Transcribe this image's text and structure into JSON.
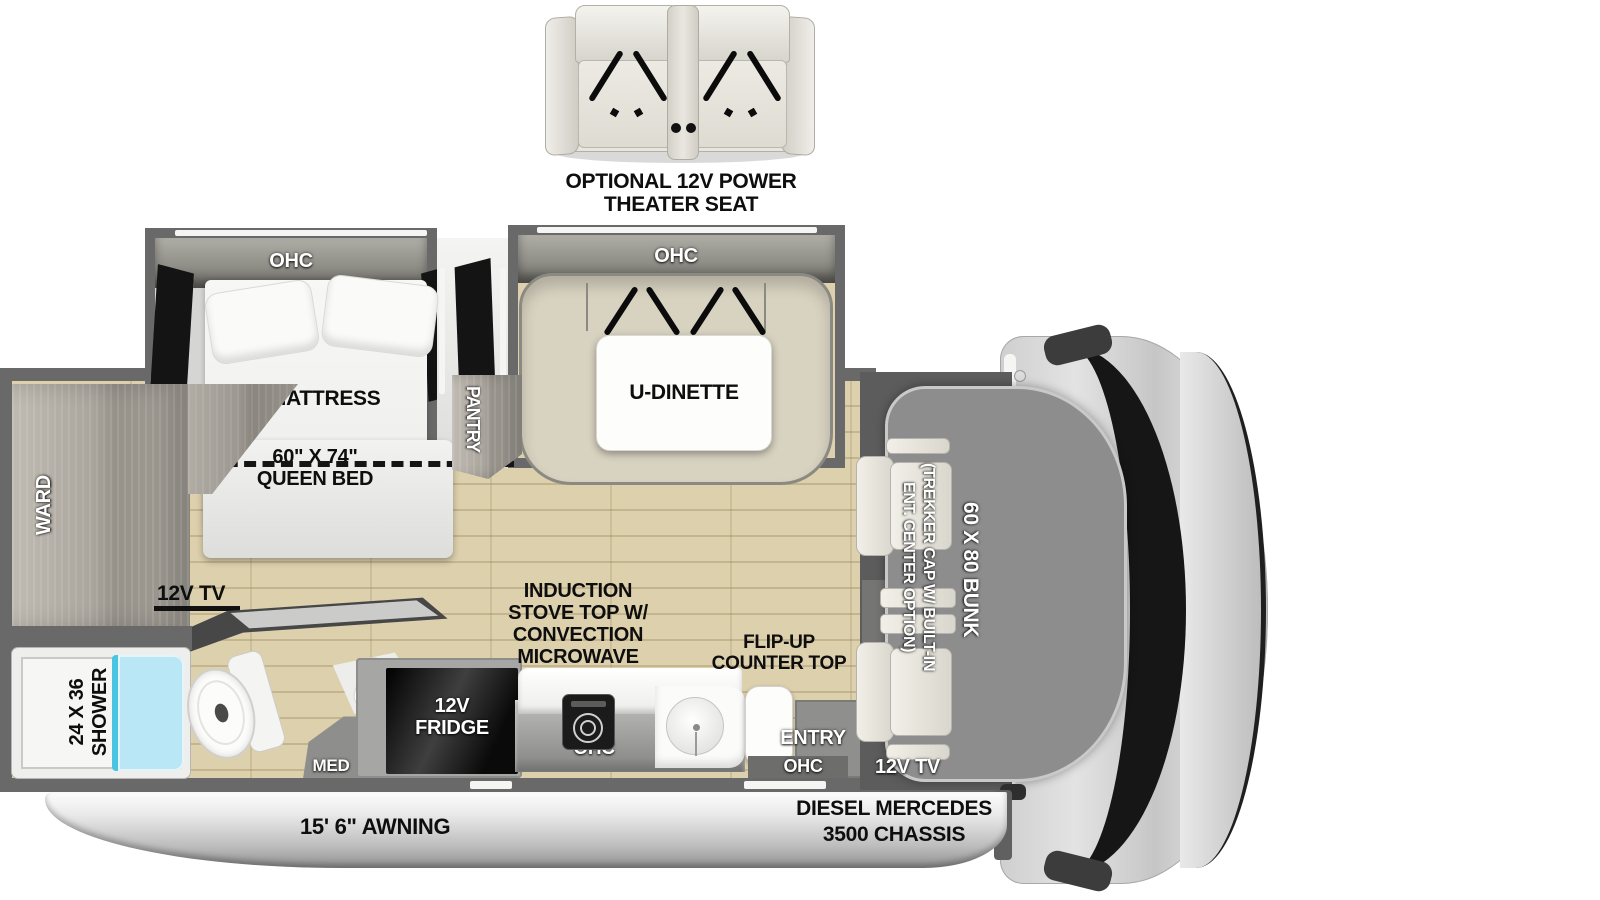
{
  "optional_seat": {
    "line1": "OPTIONAL 12V POWER",
    "line2": "THEATER SEAT"
  },
  "bedroom": {
    "ohc": "OHC",
    "wedge_label": "WEDGE MATTRESS",
    "bed_size": "60\" X 74\"",
    "bed_type": "QUEEN BED",
    "tv_label": "12V TV"
  },
  "dinette": {
    "ohc": "OHC",
    "label": "U-DINETTE"
  },
  "storage": {
    "ward_label": "WARD",
    "pantry_label": "PANTRY"
  },
  "bathroom": {
    "shower_size": "24 X 36",
    "shower_label": "SHOWER",
    "med_label": "MED"
  },
  "kitchen": {
    "fridge_line1": "12V",
    "fridge_line2": "FRIDGE",
    "induction_lines": [
      "INDUCTION",
      "STOVE TOP W/",
      "CONVECTION",
      "MICROWAVE"
    ],
    "counter_ohc": "OHC",
    "flipup_line1": "FLIP-UP",
    "flipup_line2": "COUNTER TOP",
    "entry_label": "ENTRY",
    "entry_ohc": "OHC"
  },
  "cab": {
    "bunk_label": "60 X 80 BUNK",
    "trekker_line1": "(TREKKER CAP W/ BUILT-IN",
    "trekker_line2": "ENT. CENTER OPTION)",
    "tv_label": "12V TV"
  },
  "exterior": {
    "awning_label": "15' 6\" AWNING",
    "chassis_line1": "DIESEL MERCEDES",
    "chassis_line2": "3500 CHASSIS"
  },
  "colors": {
    "wall_gray": "#696969",
    "floor_beige": "#dcd0ad",
    "shower_blue": "#b9e7f5",
    "shower_blue_edge": "#49c5e2",
    "dinette_tan": "#d8d2c0",
    "bunk_gray": "#8d8d8d",
    "cab_gray": "#d8d8d8",
    "label_black": "#0e0e0e"
  }
}
